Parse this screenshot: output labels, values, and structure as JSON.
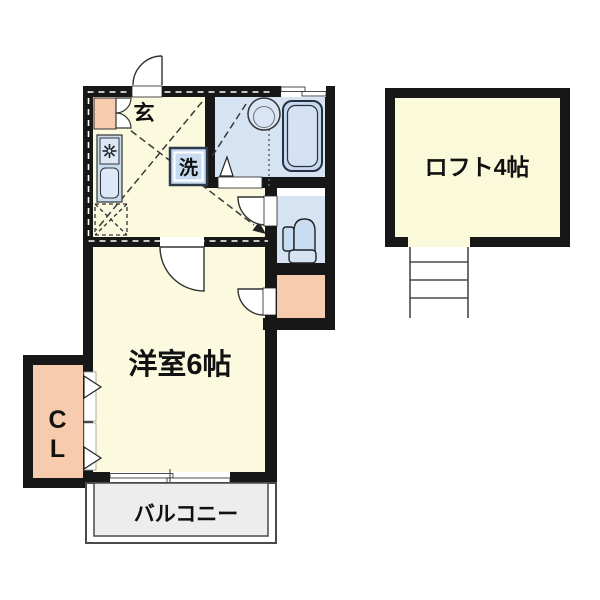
{
  "plan": {
    "title": "1K apartment floor plan with loft",
    "labels": {
      "genkan": "玄",
      "washer": "洗",
      "main_room": "洋室6帖",
      "closet_line1": "C",
      "closet_line2": "L",
      "balcony": "バルコニー",
      "loft": "ロフト4帖"
    },
    "colors": {
      "wall": "#171717",
      "room_yellow": "#FBFADF",
      "wet_area_blue": "#D5E3F3",
      "fixture_blue": "#C8DCF1",
      "fixture_blue_light": "#DCE8F7",
      "accent_salmon": "#F7CBAD",
      "balcony_gray": "#EDEDED",
      "loft_cream": "#FAF9DA",
      "line_dark": "#333333"
    },
    "icons": {
      "stove": "burner-star-icon",
      "sink": "rounded-basin-icon",
      "washbasin": "circle-basin-icon",
      "bathtub": "tub-icon",
      "toilet": "toilet-side-icon",
      "washer": "washing-machine-square-icon",
      "refrigerator": "dashed-square-x-icon",
      "doors": "quarter-circle-swing-icon",
      "closet_doors": "folding-door-triangle-icon",
      "ladder": "loft-ladder-icon"
    }
  }
}
